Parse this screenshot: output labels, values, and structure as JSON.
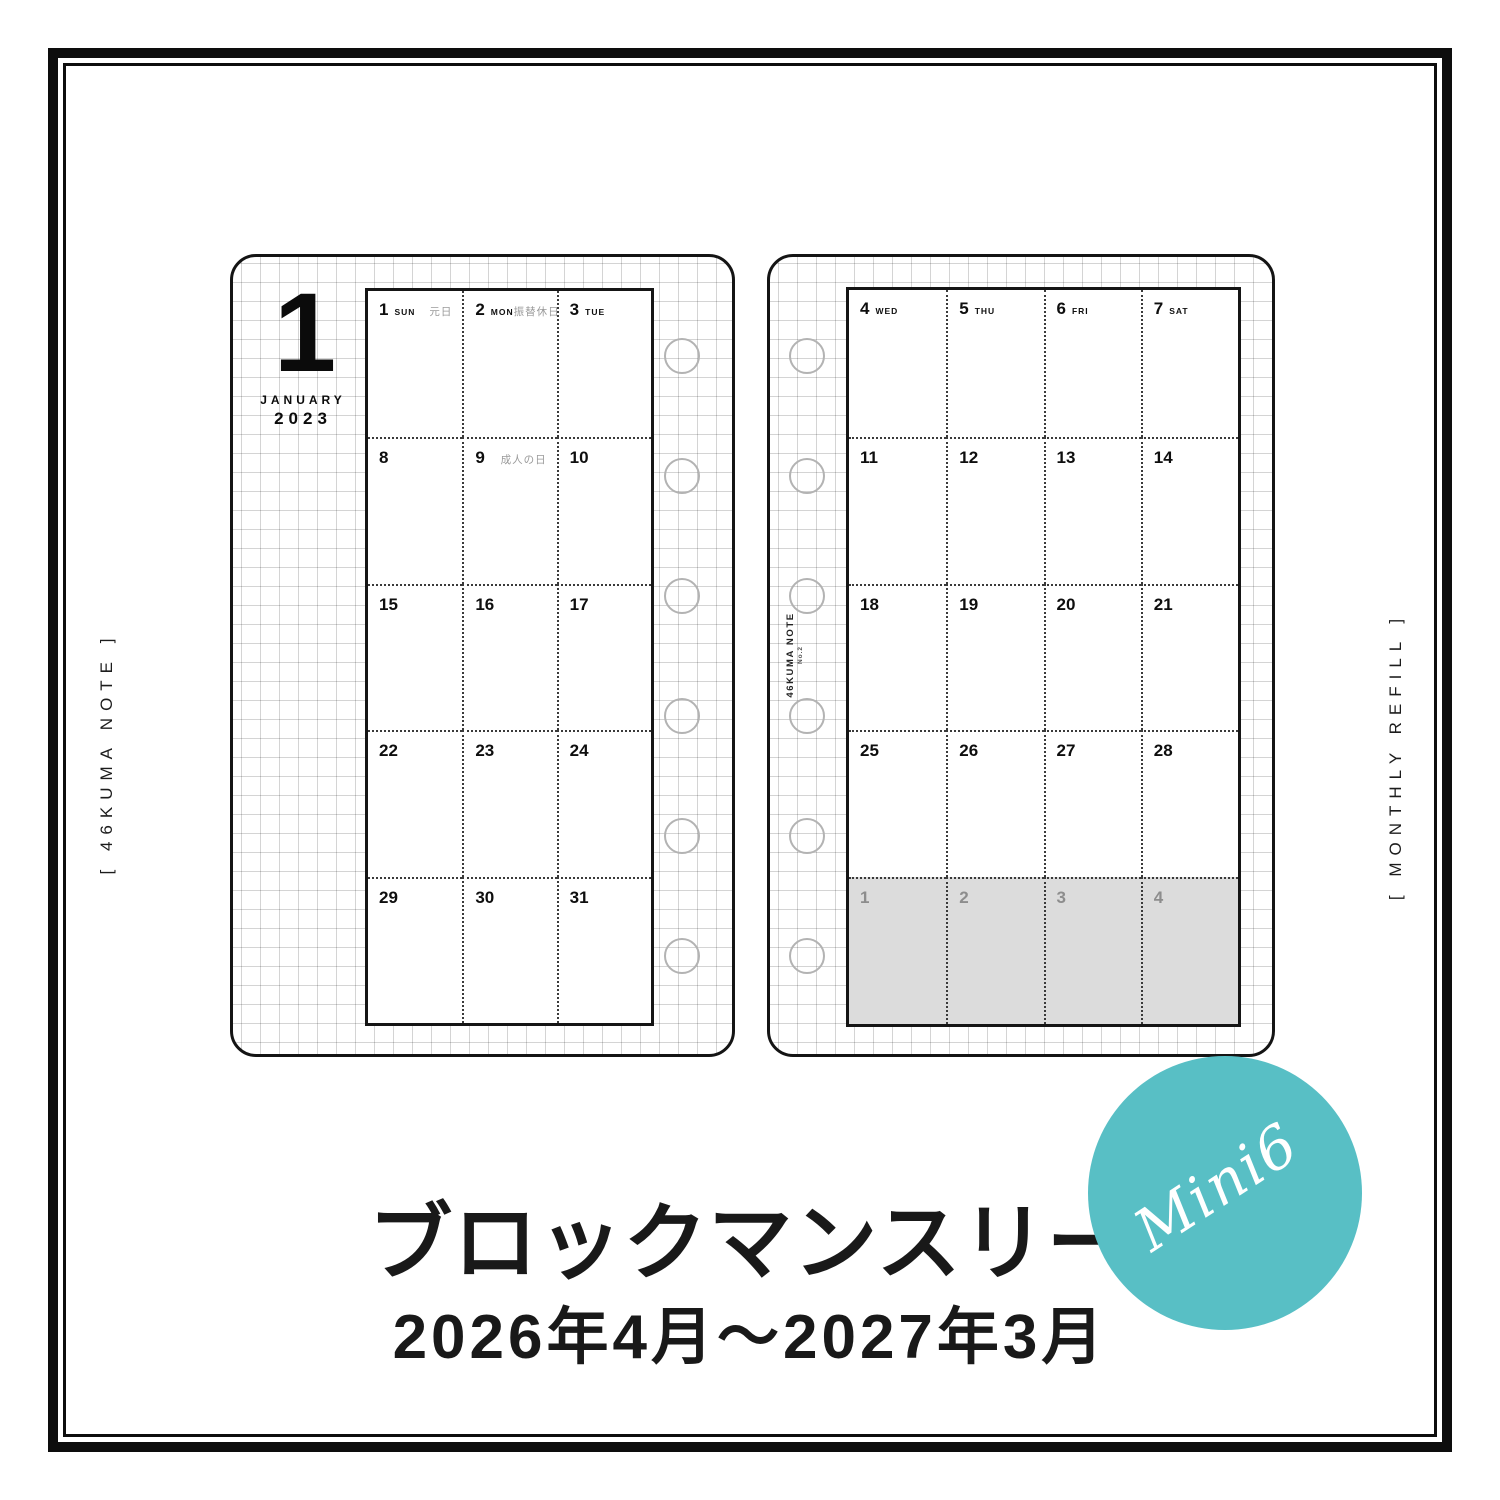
{
  "frame": {
    "left_label": "[ 46KUMA NOTE ]",
    "right_label": "[ MONTHLY REFILL ]"
  },
  "left_page": {
    "month_numeral": "1",
    "month_name": "JANUARY",
    "year": "2023",
    "rows": [
      [
        {
          "day": "1",
          "dow": "SUN",
          "holiday": "元日"
        },
        {
          "day": "2",
          "dow": "MON",
          "holiday": "振替休日"
        },
        {
          "day": "3",
          "dow": "TUE"
        }
      ],
      [
        {
          "day": "8"
        },
        {
          "day": "9",
          "holiday": "成人の日"
        },
        {
          "day": "10"
        }
      ],
      [
        {
          "day": "15"
        },
        {
          "day": "16"
        },
        {
          "day": "17"
        }
      ],
      [
        {
          "day": "22"
        },
        {
          "day": "23"
        },
        {
          "day": "24"
        }
      ],
      [
        {
          "day": "29"
        },
        {
          "day": "30"
        },
        {
          "day": "31"
        }
      ]
    ]
  },
  "right_page": {
    "spine_label": "46KUMA NOTE",
    "spine_sublabel": "No.2",
    "rows": [
      [
        {
          "day": "4",
          "dow": "WED"
        },
        {
          "day": "5",
          "dow": "THU"
        },
        {
          "day": "6",
          "dow": "FRI"
        },
        {
          "day": "7",
          "dow": "SAT"
        }
      ],
      [
        {
          "day": "11"
        },
        {
          "day": "12"
        },
        {
          "day": "13"
        },
        {
          "day": "14"
        }
      ],
      [
        {
          "day": "18"
        },
        {
          "day": "19"
        },
        {
          "day": "20"
        },
        {
          "day": "21"
        }
      ],
      [
        {
          "day": "25"
        },
        {
          "day": "26"
        },
        {
          "day": "27"
        },
        {
          "day": "28"
        }
      ],
      [
        {
          "day": "1",
          "muted": true
        },
        {
          "day": "2",
          "muted": true
        },
        {
          "day": "3",
          "muted": true
        },
        {
          "day": "4",
          "muted": true
        }
      ]
    ]
  },
  "badge": {
    "label": "Mini6",
    "color": "#58bfc5"
  },
  "title": "ブロックマンスリー",
  "subtitle": "2026年4月〜2027年3月",
  "colors": {
    "frame_black": "#0d0d0d",
    "badge_teal": "#58bfc5",
    "muted_row_bg": "#dcdcdc",
    "holiday_gray": "#9a9a9a",
    "grid_gray": "#cccccc"
  }
}
